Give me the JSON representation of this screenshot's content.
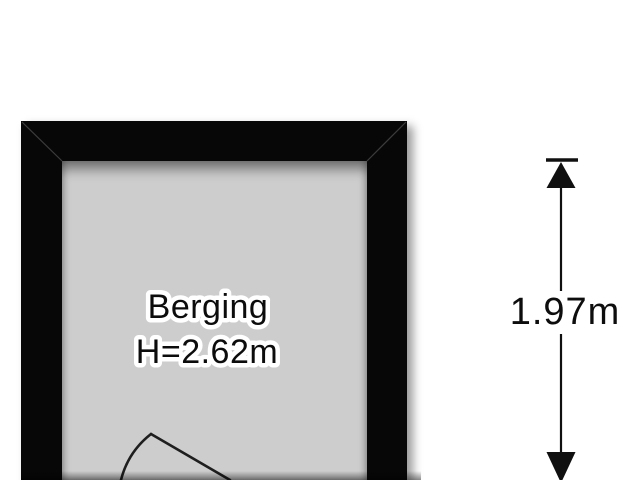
{
  "floorplan": {
    "background_color": "#ffffff",
    "room": {
      "name": "Berging",
      "height_label": "H=2.62m",
      "wall_color": "#070707",
      "floor_color": "#cdcdcd",
      "label_text_color": "#0c0c0c",
      "label_halo_color": "#ffffff"
    },
    "door": {
      "symbol": "door-swing-arc",
      "line_color": "#1e1e1e"
    },
    "dimension": {
      "value": "1.97m",
      "line_color": "#101010",
      "orientation": "vertical"
    }
  }
}
